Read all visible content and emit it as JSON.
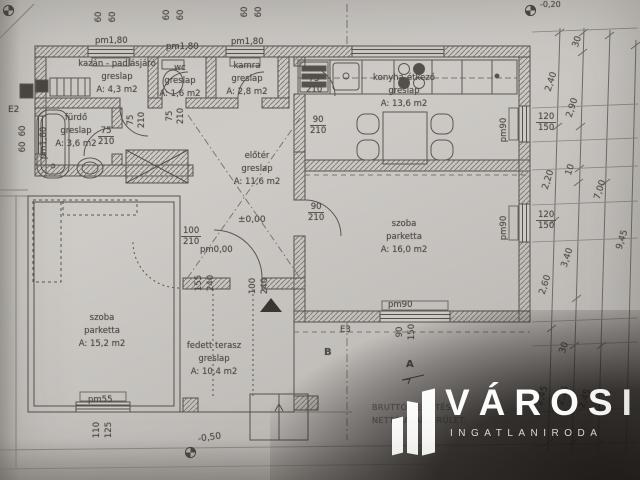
{
  "rooms": [
    {
      "name": "kazán - padlásjáró",
      "material": "greslap",
      "area": "A: 4,3 m2"
    },
    {
      "name": "wc",
      "material": "greslap",
      "area": "A: 1,6 m2"
    },
    {
      "name": "kamra",
      "material": "greslap",
      "area": "A: 2,8 m2"
    },
    {
      "name": "konyha-étkező",
      "material": "greslap",
      "area": "A: 13,6 m2"
    },
    {
      "name": "fürdő",
      "material": "greslap",
      "area": "A: 3,6 m2"
    },
    {
      "name": "előtér",
      "material": "greslap",
      "area": "A: 11,6 m2"
    },
    {
      "name": "szoba",
      "material": "parketta",
      "area": "A: 16,0 m2"
    },
    {
      "name": "szoba",
      "material": "parketta",
      "area": "A: 15,2 m2"
    },
    {
      "name": "fedett terasz",
      "material": "greslap",
      "area": "A: 10,4 m2"
    }
  ],
  "dims": {
    "w60": "60",
    "pm180": "pm1,80",
    "pm90": "pm90",
    "pm55": "pm55",
    "pm000": "pm0,00",
    "d75": "75",
    "d90": "90",
    "d100": "100",
    "d110": "110",
    "d125": "125",
    "d155": "155",
    "d210": "210",
    "d240": "240",
    "w120": "120",
    "w150": "150",
    "level0": "±0,00",
    "lm50": "-0,50",
    "lm20": "-0,20",
    "r240": "2,40",
    "r290": "2,90",
    "r30": "30",
    "r220": "2,20",
    "r10": "10",
    "r700": "7,00",
    "r260": "2,60",
    "r340": "3,40",
    "r245": "2,45",
    "r215": "2,15",
    "r945": "9,45"
  },
  "markers": {
    "e2": "E2",
    "e3": "E3",
    "a": "A",
    "b": "B"
  },
  "footer": {
    "line1": "BRUTTÓ BEÉPÍTÉS:",
    "line2": "NETTÓ ALAPTERÜLET:"
  },
  "logo": {
    "title": "VÁROSI",
    "subtitle": "INGATLANIRODA"
  },
  "colors": {
    "line": "#55514c",
    "paper": "#c8c5c1",
    "shadow": "#181412",
    "logo_text": "#fcfcfb"
  }
}
